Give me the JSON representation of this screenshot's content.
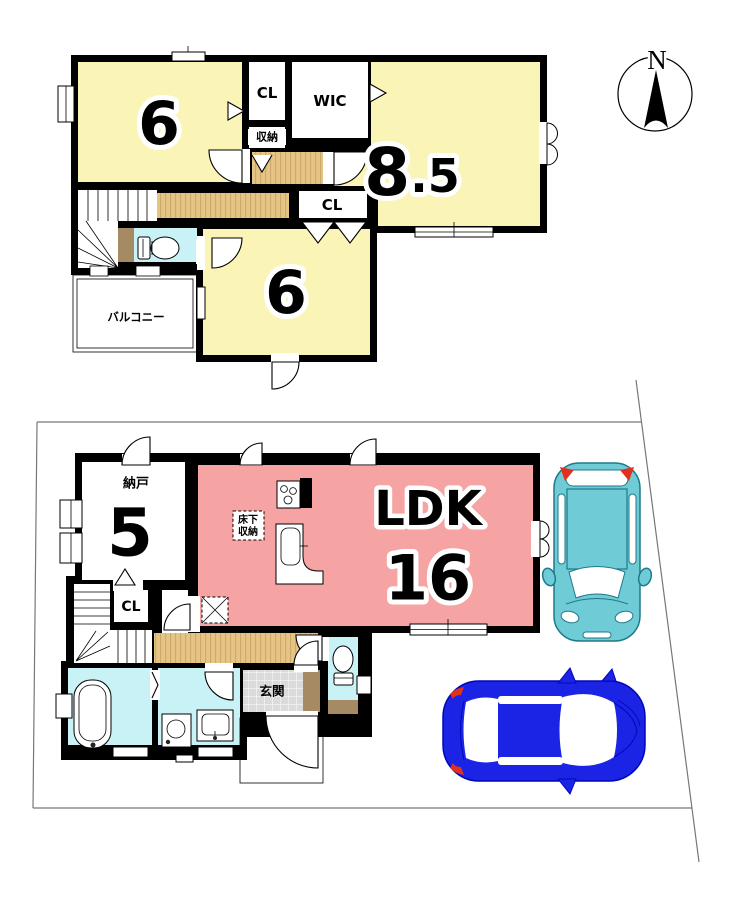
{
  "compass": {
    "north_label": "N"
  },
  "floor_2f": {
    "bedroom_nw": {
      "size_label": "6"
    },
    "closet_north": {
      "label": "CL"
    },
    "storage": {
      "label": "収納"
    },
    "wic": {
      "label": "WIC"
    },
    "bedroom_east": {
      "size_int": "8",
      "size_frac": ".5"
    },
    "closet_mid": {
      "label": "CL"
    },
    "bedroom_south": {
      "size_label": "6"
    },
    "balcony": {
      "label": "バルコニー"
    }
  },
  "floor_1f": {
    "storage_room": {
      "name_label": "納戸",
      "size_label": "5"
    },
    "ldk": {
      "name_label": "LDK",
      "size_label": "16"
    },
    "underfloor_storage": {
      "label_line1": "床下",
      "label_line2": "収納"
    },
    "closet": {
      "label": "CL"
    },
    "entrance": {
      "label": "玄関"
    }
  },
  "colors": {
    "wall": "#000000",
    "room_yellow": "#FAF4B6",
    "ldk_pink": "#F5A3A3",
    "floor_wood": "#E5C484",
    "floor_wood_stripe": "#C9A76B",
    "water_cyan": "#C9F2F7",
    "bathtub_cyan": "#A5E8F2",
    "balcony_gray": "#DCDCDC",
    "tile_gray": "#DBDBDB",
    "step_brown": "#A58A64",
    "car_teal": "#6FCBD6",
    "car_blue": "#1B23E4",
    "accent_red": "#E03020",
    "boundary_gray": "#777777"
  }
}
